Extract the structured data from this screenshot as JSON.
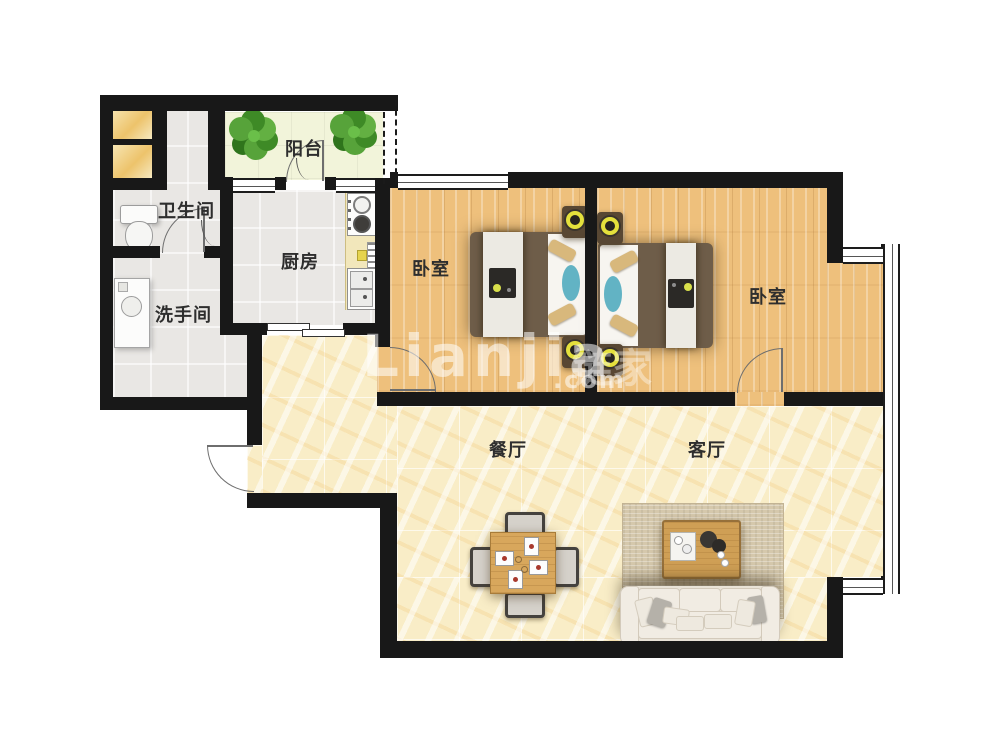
{
  "floorplan": {
    "rooms": [
      {
        "id": "balcony",
        "label": "阳台"
      },
      {
        "id": "bathroom",
        "label": "卫生间"
      },
      {
        "id": "kitchen",
        "label": "厨房"
      },
      {
        "id": "washroom",
        "label": "洗手间"
      },
      {
        "id": "bedroom-1",
        "label": "卧室"
      },
      {
        "id": "bedroom-2",
        "label": "卧室"
      },
      {
        "id": "dining",
        "label": "餐厅"
      },
      {
        "id": "living",
        "label": "客厅"
      }
    ],
    "watermark": {
      "brand": "Lianjia",
      "brand_cn": "链家",
      "domain": ".com"
    },
    "colors": {
      "wall": "#181818",
      "wood_floor": "#eec07c",
      "marble_floor": "#f9edc7",
      "tile_floor": "#e9e7e4",
      "balcony_floor": "#f2f4da",
      "lamp_accent": "#e4e03c",
      "teal_accent": "#62b3c4",
      "plant_green": "#4c9930"
    }
  }
}
